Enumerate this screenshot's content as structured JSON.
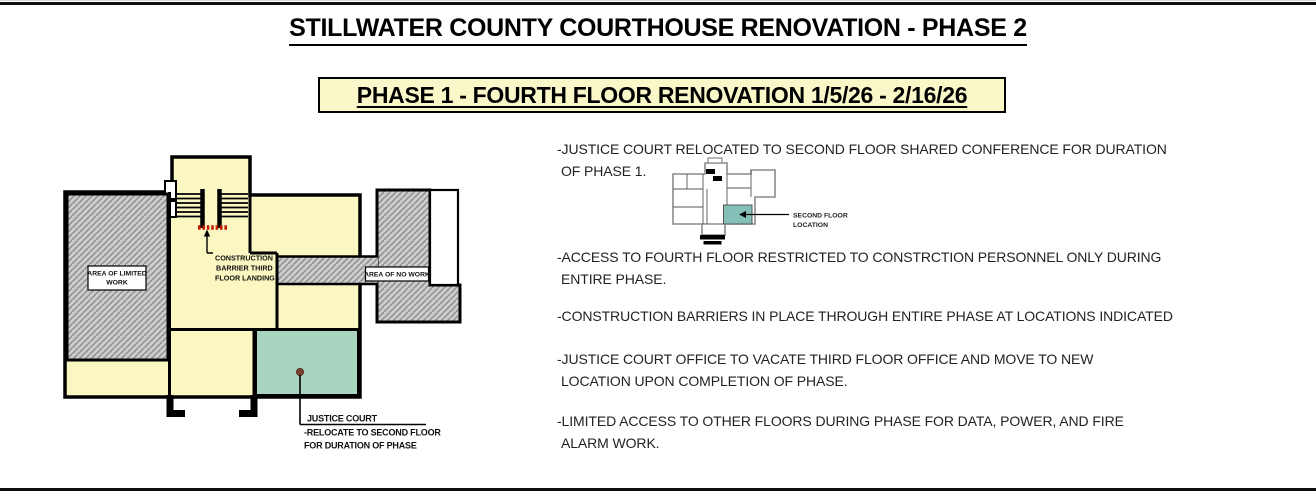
{
  "header": {
    "title": "STILLWATER COUNTY COURTHOUSE RENOVATION - PHASE 2",
    "phase_banner": "PHASE 1 - FOURTH FLOOR RENOVATION 1/5/26 - 2/16/26"
  },
  "floor_plan": {
    "area_limited_work": {
      "line1": "AREA OF LIMITED",
      "line2": "WORK"
    },
    "area_no_work": "AREA OF NO WORK",
    "construction_barrier": {
      "line1": "CONSTRUCTION",
      "line2": "BARRIER THIRD",
      "line3": "FLOOR LANDING"
    },
    "justice_court": {
      "line1": "JUSTICE COURT",
      "line2": "-RELOCATE TO SECOND FLOOR",
      "line3": "FOR DURATION OF PHASE"
    }
  },
  "second_floor_inset": {
    "label_line1": "SECOND FLOOR",
    "label_line2": "LOCATION"
  },
  "notes": [
    "-JUSTICE COURT RELOCATED TO SECOND FLOOR SHARED CONFERENCE FOR DURATION\nOF PHASE 1.",
    "-ACCESS TO FOURTH FLOOR RESTRICTED TO CONSTRCTION PERSONNEL ONLY DURING\nENTIRE PHASE.",
    "-CONSTRUCTION BARRIERS IN PLACE THROUGH ENTIRE PHASE AT LOCATIONS INDICATED",
    "-JUSTICE COURT OFFICE TO VACATE THIRD FLOOR OFFICE AND MOVE TO NEW\nLOCATION UPON COMPLETION OF PHASE.",
    "-LIMITED ACCESS TO OTHER FLOORS DURING PHASE FOR DATA, POWER, AND FIRE\nALARM WORK."
  ],
  "colors": {
    "banner_yellow": "#FAF7C9",
    "plan_yellow": "#FAF7C3",
    "relocation_green": "#A9D4BF",
    "inset_teal": "#85C0B8",
    "hatch_fill": "#CCCCCC",
    "hatch_line": "#8C8C8C",
    "barrier_red": "#C11B00",
    "dot_brown": "#7A4030",
    "wall_black": "#000000"
  }
}
